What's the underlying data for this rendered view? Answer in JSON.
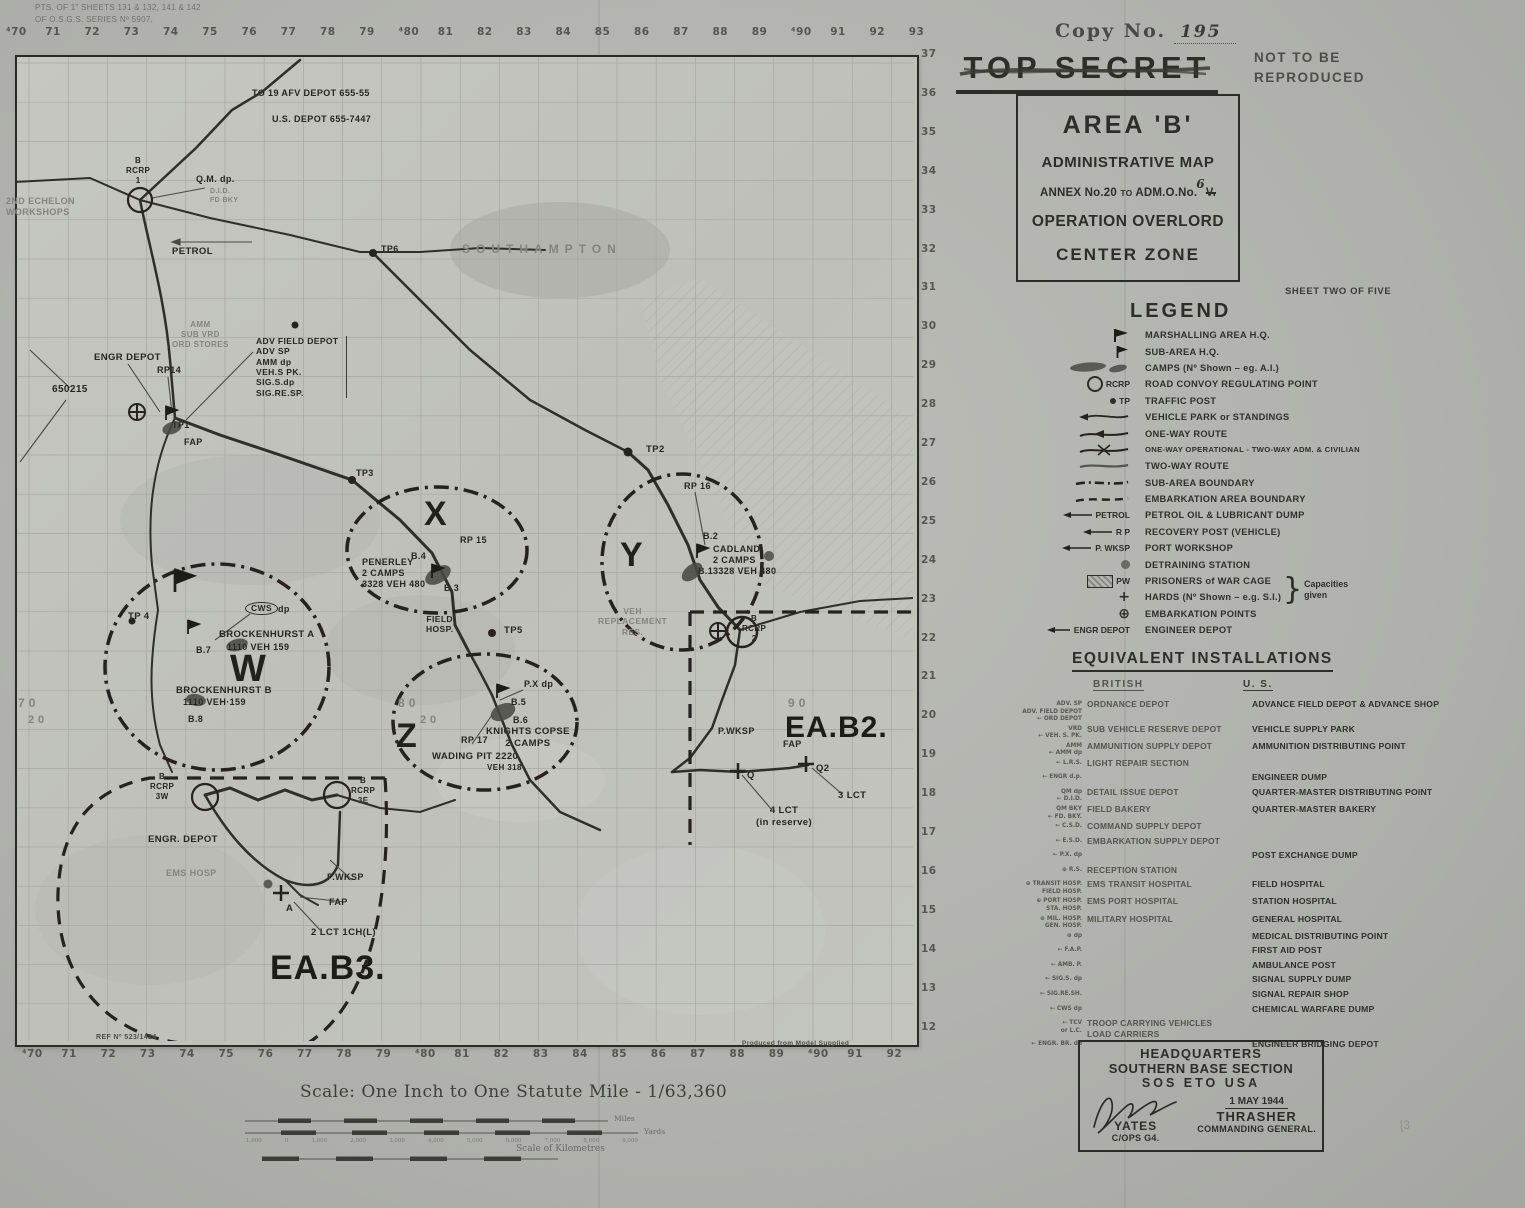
{
  "classification": {
    "copy_label": "Copy  No.",
    "copy_number": "195",
    "stamp": "TOP SECRET",
    "not_line1": "NOT  TO  BE",
    "not_line2": "REPRODUCED"
  },
  "title_box": {
    "line1": "AREA 'B'",
    "line2": "ADMINISTRATIVE MAP",
    "line3_prefix": "ANNEX No.20",
    "line3_to": "TO",
    "line3_mid": "ADM.O.No.",
    "line3_old": "V.",
    "line3_new": "6",
    "line4": "OPERATION OVERLORD",
    "line5": "CENTER ZONE"
  },
  "sheet_note": "SHEET TWO OF FIVE",
  "legend": {
    "heading": "LEGEND",
    "capacities": "Capacities\ngiven",
    "items": [
      {
        "sym": "",
        "label": "MARSHALLING AREA H.Q."
      },
      {
        "sym": "",
        "label": "SUB-AREA H.Q."
      },
      {
        "sym": "",
        "label": "CAMPS (Nº Shown – eg. A.I.)"
      },
      {
        "sym": "RCRP",
        "label": "ROAD CONVOY REGULATING POINT"
      },
      {
        "sym": "TP",
        "label": "TRAFFIC POST"
      },
      {
        "sym": "",
        "label": "VEHICLE PARK or STANDINGS"
      },
      {
        "sym": "",
        "label": "ONE-WAY ROUTE"
      },
      {
        "sym": "",
        "label": "ONE-WAY OPERATIONAL - TWO-WAY ADM. & CIVILIAN"
      },
      {
        "sym": "",
        "label": "TWO-WAY ROUTE"
      },
      {
        "sym": "",
        "label": "SUB-AREA BOUNDARY"
      },
      {
        "sym": "",
        "label": "EMBARKATION AREA BOUNDARY"
      },
      {
        "sym": "PETROL",
        "label": "PETROL OIL & LUBRICANT DUMP"
      },
      {
        "sym": "R P",
        "label": "RECOVERY POST  (VEHICLE)"
      },
      {
        "sym": "P. WKSP",
        "label": "PORT WORKSHOP"
      },
      {
        "sym": "",
        "label": "DETRAINING STATION"
      },
      {
        "sym": "PW",
        "label": "PRISONERS of WAR CAGE"
      },
      {
        "sym": "+",
        "label": "HARDS  (Nº Shown – e.g. S.I.)"
      },
      {
        "sym": "⊕",
        "label": "EMBARKATION POINTS"
      },
      {
        "sym": "ENGR DEPOT",
        "label": "ENGINEER DEPOT"
      }
    ]
  },
  "equivalents": {
    "heading": "EQUIVALENT  INSTALLATIONS",
    "col_british": "BRITISH",
    "col_us": "U. S.",
    "rows": [
      {
        "sym": "ADV. SP\nADV. FIELD DEPOT\n← ORD DEPOT",
        "british": "ORDNANCE DEPOT",
        "us": "ADVANCE FIELD DEPOT & ADVANCE SHOP"
      },
      {
        "sym": "VRD\n← VEH. S. PK.",
        "british": "SUB VEHICLE RESERVE DEPOT",
        "us": "VEHICLE SUPPLY PARK"
      },
      {
        "sym": "AMM\n← AMM dp",
        "british": "AMMUNITION SUPPLY DEPOT",
        "us": "AMMUNITION DISTRIBUTING POINT"
      },
      {
        "sym": "← L.R.S.",
        "british": "LIGHT REPAIR SECTION",
        "us": ""
      },
      {
        "sym": "← ENGR d.p.",
        "british": "",
        "us": "ENGINEER DUMP"
      },
      {
        "sym": "QM dp\n← D.I.D.",
        "british": "DETAIL ISSUE DEPOT",
        "us": "QUARTER-MASTER DISTRIBUTING POINT"
      },
      {
        "sym": "QM BKY\n← FD. BKY.",
        "british": "FIELD BAKERY",
        "us": "QUARTER-MASTER BAKERY"
      },
      {
        "sym": "← C.S.D.",
        "british": "COMMAND SUPPLY DEPOT",
        "us": ""
      },
      {
        "sym": "← E.S.D.",
        "british": "EMBARKATION SUPPLY DEPOT",
        "us": ""
      },
      {
        "sym": "← P.X. dp",
        "british": "",
        "us": "POST EXCHANGE DUMP"
      },
      {
        "sym": "⊕ R.S.",
        "british": "RECEPTION STATION",
        "us": ""
      },
      {
        "sym": "⊕ TRANSIT HOSP.\nFIELD HOSP.",
        "british": "EMS TRANSIT HOSPITAL",
        "us": "FIELD HOSPITAL"
      },
      {
        "sym": "⊕ PORT HOSP.\nSTA. HOSP.",
        "british": "EMS PORT HOSPITAL",
        "us": "STATION HOSPITAL"
      },
      {
        "sym": "⊕ MIL. HOSP.\nGEN. HOSP.",
        "british": "MILITARY HOSPITAL",
        "us": "GENERAL HOSPITAL"
      },
      {
        "sym": "⊕ dp",
        "british": "",
        "us": "MEDICAL DISTRIBUTING POINT"
      },
      {
        "sym": "← F.A.P.",
        "british": "",
        "us": "FIRST AID POST"
      },
      {
        "sym": "← AMB. P.",
        "british": "",
        "us": "AMBULANCE POST"
      },
      {
        "sym": "← SIG.S. dp",
        "british": "",
        "us": "SIGNAL SUPPLY DUMP"
      },
      {
        "sym": "← SIG.RE.SH.",
        "british": "",
        "us": "SIGNAL REPAIR SHOP"
      },
      {
        "sym": "← CWS dp",
        "british": "",
        "us": "CHEMICAL WARFARE DUMP"
      },
      {
        "sym": "← TCV\nor L.C.",
        "british": "TROOP CARRYING VEHICLES\nLOAD CARRIERS",
        "us": ""
      },
      {
        "sym": "← ENGR. BR. dp",
        "british": "",
        "us": "ENGINEER BRIDGING DEPOT"
      }
    ]
  },
  "hq_box": {
    "line1": "HEADQUARTERS",
    "line2": "SOUTHERN BASE SECTION",
    "line3": "SOS   ETO   USA",
    "date": "1 MAY 1944",
    "sig_name": "YATES",
    "sig_title": "C/OPS G4.",
    "cg_name": "THRASHER",
    "cg_title": "COMMANDING GENERAL."
  },
  "pencil_mark": "[3",
  "scale": {
    "title": "Scale: One Inch to One Statute Mile - 1/63,360",
    "miles": "Miles",
    "yards": "Yards",
    "km": "Scale of Kilometres",
    "yard_ticks": [
      "1,000",
      "0",
      "1,000",
      "2,000",
      "3,000",
      "4,000",
      "5,000",
      "6,000",
      "7,000",
      "8,000",
      "9,000"
    ]
  },
  "map": {
    "grid_top": [
      "⁴70",
      "71",
      "72",
      "73",
      "74",
      "75",
      "76",
      "77",
      "78",
      "79",
      "⁴80",
      "81",
      "82",
      "83",
      "84",
      "85",
      "86",
      "87",
      "88",
      "89",
      "⁴90",
      "91",
      "92",
      "93"
    ],
    "grid_bottom": [
      "⁴70",
      "71",
      "72",
      "73",
      "74",
      "75",
      "76",
      "77",
      "78",
      "79",
      "⁴80",
      "81",
      "82",
      "83",
      "84",
      "85",
      "86",
      "87",
      "88",
      "89",
      "⁴90",
      "91",
      "92"
    ],
    "grid_right": [
      "37",
      "36",
      "35",
      "34",
      "33",
      "32",
      "31",
      "30",
      "29",
      "28",
      "27",
      "26",
      "25",
      "24",
      "23",
      "22",
      "21",
      "20",
      "19",
      "18",
      "17",
      "16",
      "15",
      "14",
      "13",
      "12"
    ],
    "labels": [
      {
        "t": "PTS. OF 1\" SHEETS 131 & 132, 141 & 142",
        "x": 35,
        "y": 3,
        "fs": 8,
        "c": "f2"
      },
      {
        "t": "OF O.S.G.S. SERIES Nº 5907,",
        "x": 35,
        "y": 15,
        "fs": 8,
        "c": "f2"
      },
      {
        "t": "TO 19 AFV DEPOT   655-55",
        "x": 252,
        "y": 88,
        "fs": 9
      },
      {
        "t": "U.S. DEPOT 655-7447",
        "x": 272,
        "y": 114,
        "fs": 9
      },
      {
        "t": "SOUTHAMPTON",
        "x": 462,
        "y": 242,
        "fs": 12,
        "c": "f sp"
      },
      {
        "t": "B\nRCRP\n1",
        "x": 126,
        "y": 156,
        "fs": 8,
        "c": "ctr"
      },
      {
        "t": "Q.M. dp.",
        "x": 196,
        "y": 174,
        "fs": 9
      },
      {
        "t": "D.I.D.\nFD BKY",
        "x": 210,
        "y": 188,
        "fs": 7,
        "c": "f"
      },
      {
        "t": "2ND ECHELON\nWORKSHOPS",
        "x": 6,
        "y": 196,
        "fs": 9,
        "c": "f"
      },
      {
        "t": "PETROL",
        "x": 172,
        "y": 246,
        "fs": 9.5
      },
      {
        "t": "TP6",
        "x": 381,
        "y": 244,
        "fs": 9
      },
      {
        "t": "ADV FIELD DEPOT\nADV SP\nAMM dp\nVEH.S PK.\nSIG.S.dp\nSIG.RE.SP.",
        "x": 256,
        "y": 336,
        "fs": 8.5,
        "c": "box-r"
      },
      {
        "t": "ENGR  DEPOT",
        "x": 94,
        "y": 352,
        "fs": 9.5
      },
      {
        "t": "RP14",
        "x": 157,
        "y": 365,
        "fs": 9
      },
      {
        "t": "AMM\nSUB VRD\nORD STORES",
        "x": 172,
        "y": 320,
        "fs": 8,
        "c": "f ctr"
      },
      {
        "t": "650215",
        "x": 52,
        "y": 384,
        "fs": 10
      },
      {
        "t": "TP1",
        "x": 172,
        "y": 420,
        "fs": 9
      },
      {
        "t": "FAP",
        "x": 184,
        "y": 437,
        "fs": 9
      },
      {
        "t": "TP3",
        "x": 356,
        "y": 468,
        "fs": 9
      },
      {
        "t": "TP2",
        "x": 646,
        "y": 444,
        "fs": 9.5
      },
      {
        "t": "RP 16",
        "x": 684,
        "y": 481,
        "fs": 9
      },
      {
        "t": "X",
        "x": 424,
        "y": 494,
        "fs": 34,
        "c": "big"
      },
      {
        "t": "RP 15",
        "x": 460,
        "y": 535,
        "fs": 9
      },
      {
        "t": "PENERLEY\n2 CAMPS\n3328 VEH 480",
        "x": 362,
        "y": 557,
        "fs": 9
      },
      {
        "t": "B.4",
        "x": 411,
        "y": 551,
        "fs": 9
      },
      {
        "t": "B.3",
        "x": 444,
        "y": 583,
        "fs": 9
      },
      {
        "t": "Y",
        "x": 620,
        "y": 535,
        "fs": 34,
        "c": "big"
      },
      {
        "t": "B.2",
        "x": 703,
        "y": 531,
        "fs": 9
      },
      {
        "t": "CADLAND\n2 CAMPS\n3328 VEH 480",
        "x": 713,
        "y": 544,
        "fs": 9
      },
      {
        "t": "B.1",
        "x": 698,
        "y": 566,
        "fs": 9
      },
      {
        "t": "VEH\nREPLACEMENT\nRES.",
        "x": 598,
        "y": 606,
        "fs": 8.5,
        "c": "f ctr"
      },
      {
        "t": "B\nRCRP\n2",
        "x": 742,
        "y": 614,
        "fs": 8,
        "c": "ctr"
      },
      {
        "t": "TP 4",
        "x": 128,
        "y": 611,
        "fs": 9.5
      },
      {
        "t": "CWS",
        "x": 245,
        "y": 602,
        "fs": 8.5,
        "c": "oval"
      },
      {
        "t": "dp",
        "x": 278,
        "y": 604,
        "fs": 9
      },
      {
        "t": "BROCKENHURST  A",
        "x": 219,
        "y": 629,
        "fs": 9.5
      },
      {
        "t": "1110     VEH 159",
        "x": 227,
        "y": 642,
        "fs": 9
      },
      {
        "t": "B.7",
        "x": 196,
        "y": 645,
        "fs": 9
      },
      {
        "t": "W",
        "x": 230,
        "y": 646,
        "fs": 38,
        "c": "big"
      },
      {
        "t": "BROCKENHURST  B",
        "x": 176,
        "y": 685,
        "fs": 9.5
      },
      {
        "t": "1110    VEH·159",
        "x": 183,
        "y": 697,
        "fs": 9
      },
      {
        "t": "B.8",
        "x": 188,
        "y": 714,
        "fs": 9
      },
      {
        "t": "FIELD\nHOSP.",
        "x": 426,
        "y": 614,
        "fs": 8.5,
        "c": "ctr"
      },
      {
        "t": "TP5",
        "x": 504,
        "y": 625,
        "fs": 9.5
      },
      {
        "t": "Z",
        "x": 396,
        "y": 716,
        "fs": 34,
        "c": "big"
      },
      {
        "t": "P.X dp",
        "x": 524,
        "y": 679,
        "fs": 9
      },
      {
        "t": "B.5",
        "x": 511,
        "y": 697,
        "fs": 9
      },
      {
        "t": "B.6",
        "x": 513,
        "y": 715,
        "fs": 9
      },
      {
        "t": "KNIGHTS COPSE\n2 CAMPS",
        "x": 486,
        "y": 726,
        "fs": 9.5,
        "c": "ctr"
      },
      {
        "t": "RP 17",
        "x": 461,
        "y": 735,
        "fs": 9
      },
      {
        "t": "WADING PIT 2220",
        "x": 432,
        "y": 751,
        "fs": 9.5
      },
      {
        "t": "VEH 318",
        "x": 487,
        "y": 763,
        "fs": 8
      },
      {
        "t": "P.WKSP",
        "x": 718,
        "y": 726,
        "fs": 9
      },
      {
        "t": "EA.B2.",
        "x": 785,
        "y": 710,
        "fs": 30,
        "c": "huge"
      },
      {
        "t": "FAP",
        "x": 783,
        "y": 739,
        "fs": 9
      },
      {
        "t": "Q2",
        "x": 816,
        "y": 763,
        "fs": 9.5
      },
      {
        "t": "Q",
        "x": 747,
        "y": 770,
        "fs": 9.5
      },
      {
        "t": "3 LCT",
        "x": 838,
        "y": 790,
        "fs": 9.5
      },
      {
        "t": "4 LCT\n(in reserve)",
        "x": 756,
        "y": 805,
        "fs": 9.5,
        "c": "ctr"
      },
      {
        "t": "B\nRCRP\n3W",
        "x": 150,
        "y": 772,
        "fs": 8,
        "c": "ctr"
      },
      {
        "t": "B\nRCRP\n3E",
        "x": 351,
        "y": 776,
        "fs": 8,
        "c": "ctr"
      },
      {
        "t": "ENGR.  DEPOT",
        "x": 148,
        "y": 834,
        "fs": 9.5
      },
      {
        "t": "EMS  HOSP",
        "x": 166,
        "y": 868,
        "fs": 9,
        "c": "f"
      },
      {
        "t": "P.WKSP",
        "x": 327,
        "y": 872,
        "fs": 9
      },
      {
        "t": "FAP",
        "x": 329,
        "y": 897,
        "fs": 9
      },
      {
        "t": "A",
        "x": 286,
        "y": 903,
        "fs": 9.5
      },
      {
        "t": "2 LCT 1CH(L)",
        "x": 311,
        "y": 927,
        "fs": 9.5
      },
      {
        "t": "EA.B3.",
        "x": 270,
        "y": 948,
        "fs": 34,
        "c": "huge"
      },
      {
        "t": "REF Nº 523/1424",
        "x": 96,
        "y": 1034,
        "fs": 7,
        "c": "sm"
      },
      {
        "t": "Produced  from  Model  Supplied",
        "x": 742,
        "y": 1040,
        "fs": 6.5,
        "c": "sm"
      },
      {
        "t": "7 0",
        "x": 18,
        "y": 696,
        "fs": 12,
        "c": "f"
      },
      {
        "t": "2 0",
        "x": 28,
        "y": 714,
        "fs": 11,
        "c": "f"
      },
      {
        "t": "8 0",
        "x": 398,
        "y": 696,
        "fs": 12,
        "c": "f"
      },
      {
        "t": "2 0",
        "x": 420,
        "y": 714,
        "fs": 11,
        "c": "f"
      },
      {
        "t": "9 0",
        "x": 788,
        "y": 696,
        "fs": 12,
        "c": "f"
      }
    ]
  }
}
